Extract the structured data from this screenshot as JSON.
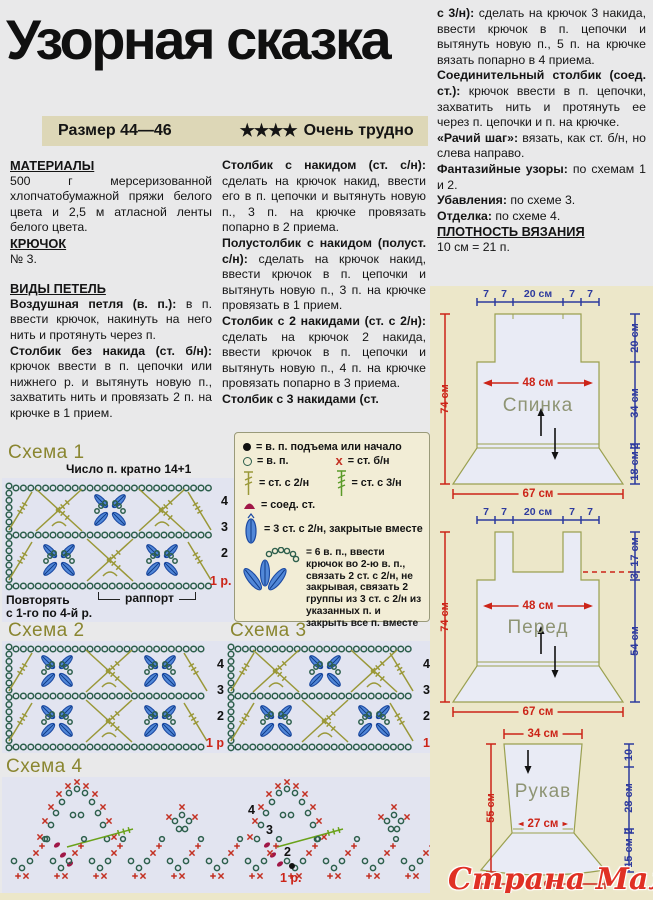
{
  "page": {
    "title": "Узорная сказка",
    "size_label": "Размер 44—46",
    "difficulty_stars": "★★★★",
    "difficulty_label": "Очень трудно",
    "watermark": "Страна Мам"
  },
  "columns": {
    "left": {
      "h1": "МАТЕРИАЛЫ",
      "materials": "500 г мерсеризованной хлопчатобумажной пряжи белого цвета и 2,5 м атласной ленты белого цвета.",
      "h2": "КРЮЧОК",
      "hook": "№ 3.",
      "h3": "ВИДЫ ПЕТЕЛЬ",
      "paragraphs": [
        {
          "bold": "Воздушная петля (в. п.):",
          "text": " в п. ввести крючок, накинуть на него нить и протянуть через п."
        },
        {
          "bold": "Столбик без накида (ст. б/н):",
          "text": " крючок ввести в п. цепочки или нижнего р. и вытянуть новую п., захватить нить и провязать 2 п. на крючке в 1 прием."
        }
      ]
    },
    "middle": {
      "paragraphs": [
        {
          "bold": "Столбик с накидом (ст. с/н):",
          "text": " сделать на крючок накид, ввести его в п. цепочки и вытянуть новую п., 3 п. на крючке провязать попарно в 2 приема."
        },
        {
          "bold": "Полустолбик с накидом (полуст. с/н):",
          "text": " сделать на крючок накид, ввести крючок в п. цепочки и вытянуть новую п., 3 п. на крючке провязать в 1 прием."
        },
        {
          "bold": "Столбик с 2 накидами (ст. с 2/н):",
          "text": " сделать на крючок 2 накида, ввести крючок в п. цепочки и вытянуть новую п., 4 п. на крючке провязать попарно в 3 приема."
        },
        {
          "bold": "Столбик с 3 накидами (ст.",
          "text": ""
        }
      ]
    },
    "right": {
      "paragraphs": [
        {
          "bold": "с 3/н):",
          "text": " сделать на крючок 3 накида, ввести крючок в п. цепочки и вытянуть новую п., 5 п. на крючке вязать попарно в 4 приема."
        },
        {
          "bold": "Соединительный столбик (соед. ст.):",
          "text": " крючок ввести в п. цепочки, захватить нить и протянуть ее через п. цепочки и п. на крючке."
        },
        {
          "bold": "«Рачий шаг»:",
          "text": " вязать, как ст. б/н, но слева направо."
        },
        {
          "bold": "Фантазийные узоры:",
          "text": " по схемам 1 и 2."
        },
        {
          "bold": "Убавления:",
          "text": " по схеме 3."
        },
        {
          "bold": "Отделка:",
          "text": " по схеме 4."
        }
      ],
      "h": "ПЛОТНОСТЬ ВЯЗАНИЯ",
      "gauge": "10 см = 21 п."
    }
  },
  "legend": {
    "items": [
      {
        "symbol": "filled-circle",
        "text": "= в. п. подъема или начало"
      },
      {
        "symbol": "open-circle",
        "text": "= в. п."
      },
      {
        "symbol": "red-x",
        "glyph": "х",
        "text": "= ст. б/н"
      },
      {
        "symbol": "dc2",
        "text": "= ст. с 2/н"
      },
      {
        "symbol": "dc3",
        "text": "= ст. с 3/н"
      },
      {
        "symbol": "slip-stitch",
        "text": "= соед. ст."
      },
      {
        "symbol": "cluster-3dc2",
        "text": "= 3 ст. с 2/н, закрытые вместе"
      },
      {
        "symbol": "fan-6ch",
        "text": "= 6 в. п., ввести крючок во 2-ю в. п., связать 2 ст. с 2/н, не закрывая, связать 2 группы из 3 ст. с 2/н из указанных п. и закрыть все п. вместе"
      }
    ]
  },
  "schemas": [
    {
      "title": "Схема 1",
      "note": "Число п. кратно 14+1",
      "rows": [
        "4",
        "3",
        "2",
        "1 р."
      ],
      "repeat_line1": "Повторять",
      "repeat_line2": "с 1-го по 4-й р.",
      "rapport": "раппорт"
    },
    {
      "title": "Схема 2",
      "rows": [
        "4",
        "3",
        "2",
        "1 р."
      ]
    },
    {
      "title": "Схема 3",
      "rows": [
        "4",
        "3",
        "2",
        "1"
      ]
    },
    {
      "title": "Схема 4",
      "rows": [
        "4",
        "3",
        "2",
        "1 р."
      ]
    }
  ],
  "schematics": {
    "back": {
      "label": "Спинка",
      "top": [
        "7",
        "7",
        "20 см",
        "7",
        "7"
      ],
      "left": "74 см",
      "mid": "48 см",
      "right": [
        "20 см",
        "34 см",
        "2",
        "18 см"
      ],
      "bottom": "67 см"
    },
    "front": {
      "label": "Перед",
      "top": [
        "7",
        "7",
        "20 см",
        "7",
        "7"
      ],
      "left": "74 см",
      "mid": "48 см",
      "right": [
        "17 см",
        "3",
        "54 см"
      ],
      "bottom": "67 см"
    },
    "sleeve": {
      "label": "Рукав",
      "top": "34 см",
      "left": "55 см",
      "mid": "27 см",
      "right": [
        "10",
        "28 см",
        "2",
        "15 см"
      ],
      "bottom": "54 см"
    }
  }
}
